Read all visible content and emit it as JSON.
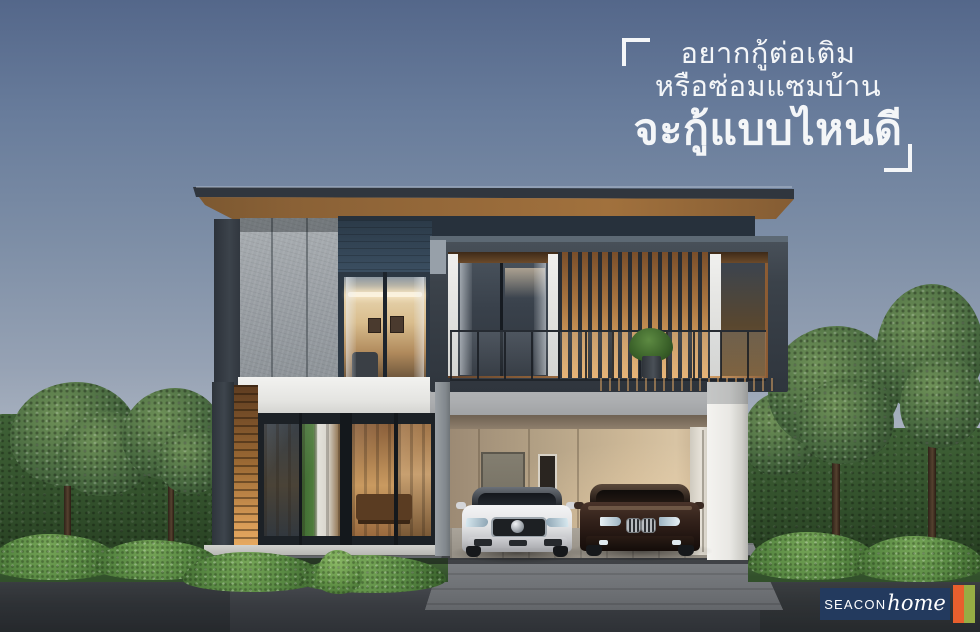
{
  "headline": {
    "line1": "อยากกู้ต่อเติม",
    "line2": "หรือซ่อมแซมบ้าน",
    "line3": "จะกู้แบบไหนดี",
    "color": "#f4f6f8"
  },
  "logo": {
    "brand_caps": "SEACON",
    "brand_script": "home",
    "box_color": "#233a5e",
    "bar_orange": "#e85f2d",
    "bar_green": "#97ad44"
  },
  "scene": {
    "type": "architectural-render-advertisement",
    "subject": "modern two-story house at dusk with balcony, glass walls and carport",
    "vehicles": [
      "white luxury sedan",
      "dark brown sedan"
    ],
    "palette": {
      "sky_top": "#54678a",
      "sky_horizon": "#ced2d6",
      "roof_fascia": "#2a3036",
      "soffit_wood": "#97683a",
      "concrete_panel": "#9ba0a4",
      "navy_panel": "#2c3845",
      "balcony_frame": "#3d444d",
      "balcony_wood": "#c08348",
      "white_band": "#ededeb",
      "carport_wall": "#bba686",
      "glass_frame": "#1c2126",
      "hedge_green": "#3a5c33",
      "bush_green": "#5d8f46",
      "road_gray": "#3a3d42",
      "driveway_gray": "#777a7e"
    }
  }
}
